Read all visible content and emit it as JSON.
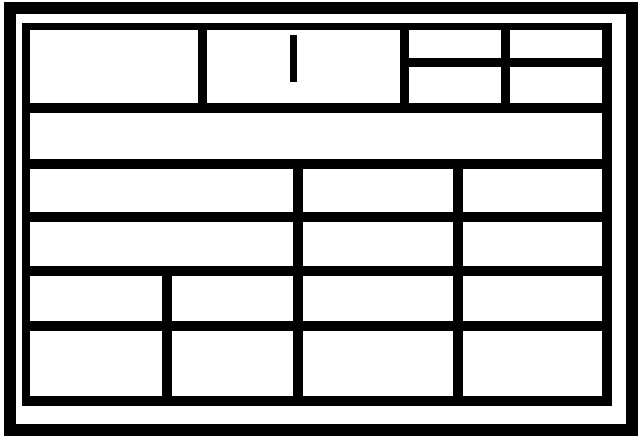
{
  "colors": {
    "ink": "#000000",
    "paper": "#ffffff"
  },
  "wireframe": {
    "marks": {
      "header_middle_cell_mark": "vertical-bar"
    },
    "structure": {
      "header_row_cells": 3,
      "header_right_grid": {
        "rows": 2,
        "cols": 2
      },
      "band_row_cells": 1,
      "row_3_cells": 3,
      "row_4_cells": 3,
      "row_5_cells": 4,
      "row_6_cells": 4
    }
  }
}
